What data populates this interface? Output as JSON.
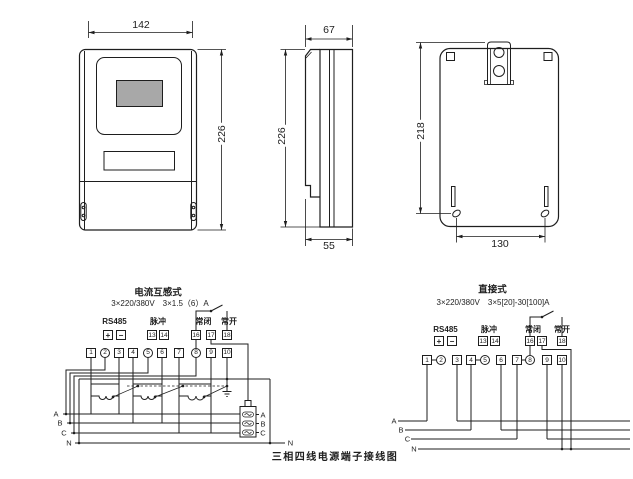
{
  "drawing": {
    "front_view": {
      "width_dim": "142",
      "height_dim": "226"
    },
    "side_view": {
      "depth_dim": "67",
      "height_dim": "226",
      "base_depth_dim": "55"
    },
    "back_view": {
      "mount_height_dim": "218",
      "mount_width_dim": "130"
    }
  },
  "ct_diagram": {
    "title": "电流互感式",
    "spec": "3×220/380V　3×1.5（6）A",
    "rs485_label": "RS485",
    "rs485_plus": "+",
    "rs485_minus": "−",
    "pulse_label": "脉冲",
    "pulse_terminals": [
      "13",
      "14"
    ],
    "nc_label": "常闭",
    "no_label": "常开",
    "relay_terminals": [
      "16",
      "17",
      "18"
    ],
    "terminals": [
      "1",
      "2",
      "3",
      "4",
      "5",
      "6",
      "7",
      "8",
      "9",
      "10"
    ],
    "phase_in": [
      "A",
      "B",
      "C",
      "N"
    ],
    "fuse_out": [
      "A",
      "B",
      "C"
    ],
    "neutral_out": "N"
  },
  "direct_diagram": {
    "title": "直接式",
    "spec": "3×220/380V　3×5[20]-30[100]A",
    "rs485_label": "RS485",
    "rs485_plus": "+",
    "rs485_minus": "−",
    "pulse_label": "脉冲",
    "pulse_terminals": [
      "13",
      "14"
    ],
    "nc_label": "常闭",
    "no_label": "常开",
    "relay_terminals": [
      "16",
      "17",
      "18"
    ],
    "terminals": [
      "1",
      "2",
      "3",
      "4",
      "5",
      "6",
      "7",
      "8",
      "9",
      "10"
    ],
    "phase_in": [
      "A",
      "B",
      "C",
      "N"
    ]
  },
  "caption": "三相四线电源端子接线图"
}
